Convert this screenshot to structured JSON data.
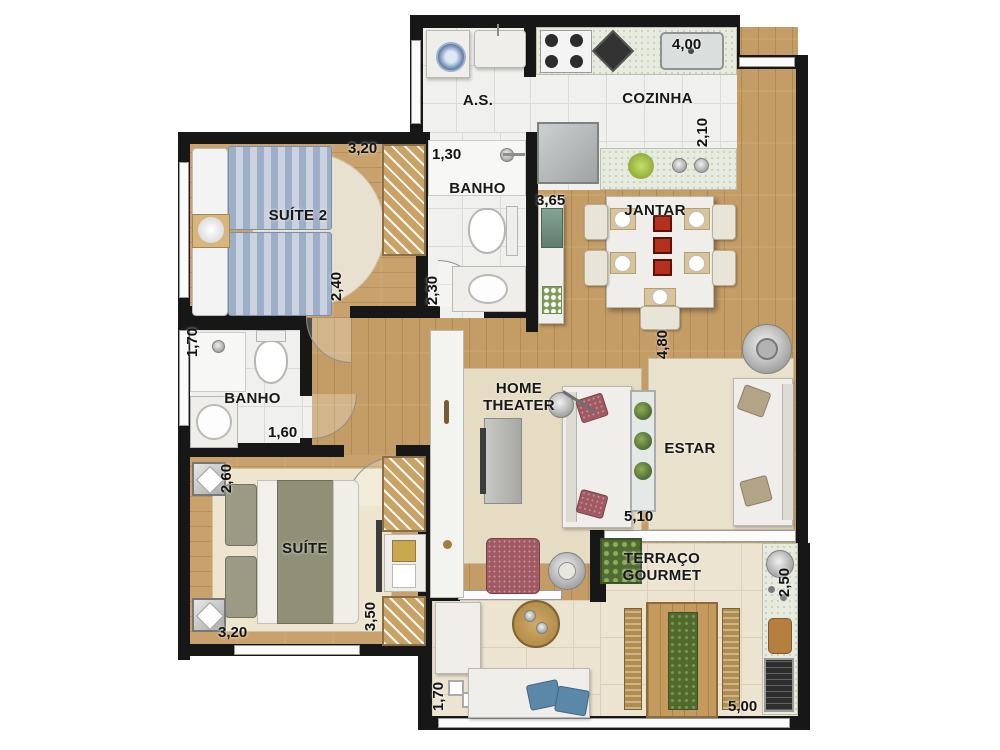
{
  "plan": {
    "title": "apartment-floor-plan",
    "rooms": {
      "as": {
        "label": "A.S."
      },
      "cozinha": {
        "label": "COZINHA"
      },
      "suite2": {
        "label": "SUÍTE 2"
      },
      "banho1": {
        "label": "BANHO"
      },
      "jantar": {
        "label": "JANTAR"
      },
      "banho2": {
        "label": "BANHO"
      },
      "home_theater": {
        "label": "HOME THEATER"
      },
      "estar": {
        "label": "ESTAR"
      },
      "suite": {
        "label": "SUÍTE"
      },
      "terraco": {
        "label": "TERRAÇO GOURMET"
      }
    },
    "dims": {
      "suite2_top": "3,20",
      "banho1_top": "1,30",
      "cozinha_top": "4,00",
      "cozinha_right": "2,10",
      "buffet_wall": "3,65",
      "suite2_right": "2,40",
      "banho1_right": "2,30",
      "banho2_left": "1,70",
      "banho2_bottom": "1,60",
      "suite_left": "2,60",
      "living_left": "4,80",
      "living_bottom": "5,10",
      "suite_bottom": "3,20",
      "suite_right": "3,50",
      "terraco_right": "2,50",
      "terraco_left": "1,70",
      "terraco_bottom": "5,00"
    },
    "colors": {
      "wall": "#171717",
      "wood_floor": "#c49c66",
      "bath_tile": "#f0f1ee",
      "terrace_tile": "#ece4d1",
      "rug": "#e6dcc2",
      "bed_blue": "#9dafc6",
      "bed_olive": "#8f9077",
      "accent_red": "#a15a64",
      "plant_green": "#4f6b33"
    }
  }
}
